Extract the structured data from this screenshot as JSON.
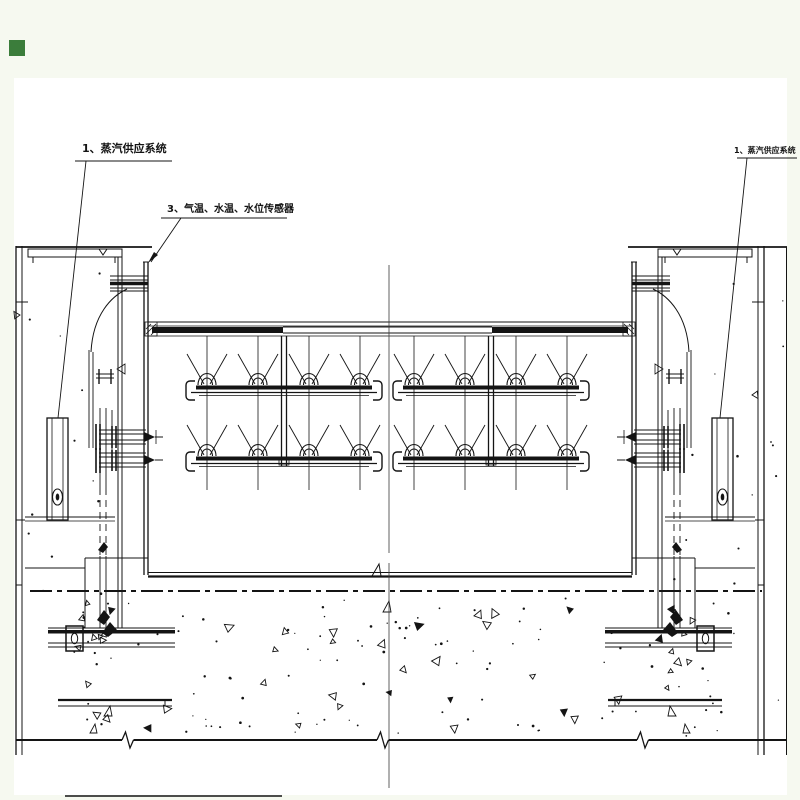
{
  "drawing": {
    "labels": {
      "steam_system_left": "1、蒸汽供应系统",
      "sensor_system": "3、气温、水温、水位传感器",
      "steam_system_right": "1、蒸汽供应系统"
    },
    "colors": {
      "page_background": "#f6f9f0",
      "canvas_background": "#ffffff",
      "line": "#141414",
      "marker_green": "#3b7d3b"
    }
  }
}
